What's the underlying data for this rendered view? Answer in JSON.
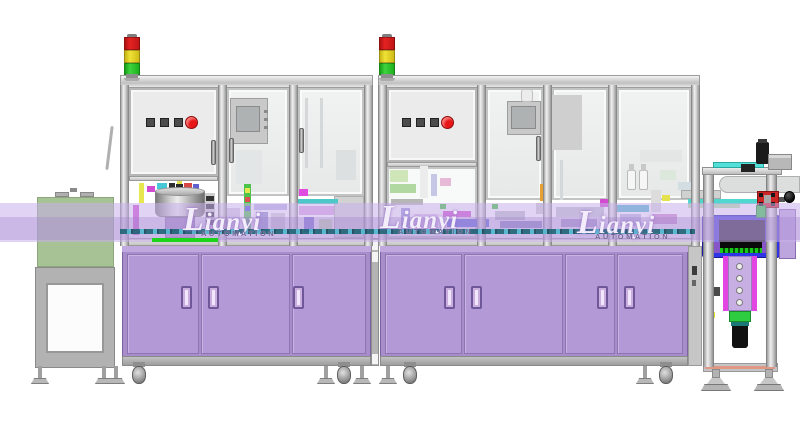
{
  "watermark": {
    "brand": "Lianyi",
    "sub": "AUTOMATION",
    "brand_color": "rgba(252,250,255,0.9)",
    "sub_color": "rgba(100,84,140,0.9)",
    "positions": [
      {
        "x": 183,
        "y": 201
      },
      {
        "x": 380,
        "y": 199
      },
      {
        "x": 577,
        "y": 204
      }
    ]
  },
  "palette": {
    "cabinet": "#a78ecb",
    "cabinet_door": "#b39ad6",
    "band": "rgba(201,174,233,0.55)",
    "band_dark": "rgba(158,128,202,0.32)",
    "tunnel_green": "#a7c295",
    "accent_green": "#1bd41b",
    "blue_box": "#2f35e6",
    "magenta": "#e245e2",
    "slide_green": "#2ecc40",
    "clamp_red": "#cc2626",
    "signal_red": "#e62222",
    "signal_yellow": "#efe235",
    "signal_green": "#3ed43e",
    "button_red": "#e81616",
    "button_gray": "#4c4c4c",
    "wm_brand": "rgba(252,250,255,0.9)",
    "wm_sub": "rgba(100,84,140,0.9)"
  },
  "towers": [
    {
      "x": 124
    },
    {
      "x": 379
    }
  ],
  "machine1": {
    "posts": [
      120,
      218,
      289,
      364
    ],
    "buttons": {
      "squares": [
        146,
        160,
        174
      ],
      "sq_y": 118,
      "red_x": 185,
      "red_y": 116
    },
    "handles": [
      {
        "x": 211,
        "y": 140
      },
      {
        "x": 229,
        "y": 138
      },
      {
        "x": 299,
        "y": 128
      }
    ]
  },
  "machine2": {
    "posts": [
      378,
      477,
      543,
      608,
      691
    ],
    "buttons": {
      "squares": [
        402,
        416,
        430
      ],
      "sq_y": 118,
      "red_x": 441,
      "red_y": 116
    },
    "handles": [
      {
        "x": 536,
        "y": 136
      },
      {
        "x": 546,
        "y": 132
      }
    ]
  },
  "cabinet1": {
    "x": 122,
    "w": 249,
    "doors": [
      [
        127,
        72
      ],
      [
        201,
        89
      ],
      [
        292,
        74
      ]
    ],
    "handles": [
      181,
      208,
      293
    ]
  },
  "cabinet2": {
    "x": 380,
    "w": 308,
    "doors": [
      [
        385,
        77
      ],
      [
        464,
        99
      ],
      [
        565,
        50
      ],
      [
        617,
        66
      ]
    ],
    "handles": [
      444,
      471,
      597,
      624
    ]
  },
  "junction": {
    "white_blocks": [
      240,
      252,
      354
    ]
  },
  "station3": {
    "holes": [
      263,
      275,
      287,
      299
    ]
  },
  "supports": {
    "feet": [
      40,
      104,
      116,
      326,
      362,
      388,
      645
    ],
    "casters": [
      139,
      344,
      410,
      666
    ],
    "big_feet": [
      716,
      769
    ]
  },
  "blocks": [
    {
      "x": 133,
      "y": 205,
      "w": 6,
      "h": 30,
      "c": "#cf49cf"
    },
    {
      "x": 139,
      "y": 183,
      "w": 5,
      "h": 20,
      "c": "#e6e64e"
    },
    {
      "x": 147,
      "y": 186,
      "w": 8,
      "h": 6,
      "c": "#d24cd2"
    },
    {
      "x": 157,
      "y": 183,
      "w": 10,
      "h": 6,
      "c": "#46c8d8"
    },
    {
      "x": 169,
      "y": 183,
      "w": 6,
      "h": 6,
      "c": "#2d2d2d"
    },
    {
      "x": 177,
      "y": 181,
      "w": 5,
      "h": 9,
      "c": "#dede46"
    },
    {
      "x": 184,
      "y": 183,
      "w": 8,
      "h": 6,
      "c": "#d84646"
    },
    {
      "x": 193,
      "y": 184,
      "w": 6,
      "h": 5,
      "c": "#6060d0"
    },
    {
      "x": 176,
      "y": 184,
      "w": 7,
      "h": 6,
      "c": "#2a2a2a"
    },
    {
      "x": 205,
      "y": 193,
      "w": 10,
      "h": 36,
      "c": "#cfcfcf"
    },
    {
      "x": 206,
      "y": 196,
      "w": 8,
      "h": 5,
      "c": "#333333"
    },
    {
      "x": 206,
      "y": 204,
      "w": 8,
      "h": 5,
      "c": "#333333"
    },
    {
      "x": 206,
      "y": 212,
      "w": 8,
      "h": 5,
      "c": "#333333"
    },
    {
      "x": 206,
      "y": 220,
      "w": 8,
      "h": 5,
      "c": "#333333"
    },
    {
      "x": 222,
      "y": 208,
      "w": 18,
      "h": 22,
      "c": "#d7cfe6"
    },
    {
      "x": 244,
      "y": 182,
      "w": 7,
      "h": 50,
      "c": "#4cc44c"
    },
    {
      "x": 245,
      "y": 188,
      "w": 5,
      "h": 5,
      "c": "#e6e64e"
    },
    {
      "x": 245,
      "y": 197,
      "w": 5,
      "h": 5,
      "c": "#e05050"
    },
    {
      "x": 245,
      "y": 206,
      "w": 5,
      "h": 5,
      "c": "#5050e0"
    },
    {
      "x": 254,
      "y": 204,
      "w": 33,
      "h": 6,
      "c": "#b9b9e6"
    },
    {
      "x": 256,
      "y": 212,
      "w": 12,
      "h": 20,
      "c": "#9090cc"
    },
    {
      "x": 271,
      "y": 213,
      "w": 14,
      "h": 18,
      "c": "#d2d2d2"
    },
    {
      "x": 299,
      "y": 189,
      "w": 9,
      "h": 7,
      "c": "#e04ce0"
    },
    {
      "x": 296,
      "y": 199,
      "w": 42,
      "h": 5,
      "c": "#4cc8c8"
    },
    {
      "x": 299,
      "y": 206,
      "w": 35,
      "h": 9,
      "c": "#d9a6e6"
    },
    {
      "x": 304,
      "y": 217,
      "w": 10,
      "h": 15,
      "c": "#6a6ad6"
    },
    {
      "x": 319,
      "y": 219,
      "w": 13,
      "h": 13,
      "c": "#c9e6a6"
    },
    {
      "x": 236,
      "y": 150,
      "w": 26,
      "h": 34,
      "c": "#e3e6e6"
    },
    {
      "x": 305,
      "y": 98,
      "w": 3,
      "h": 70,
      "c": "#d4d8d8"
    },
    {
      "x": 320,
      "y": 98,
      "w": 3,
      "h": 70,
      "c": "#d4d8d8"
    },
    {
      "x": 336,
      "y": 150,
      "w": 20,
      "h": 30,
      "c": "#dde0e0"
    },
    {
      "x": 390,
      "y": 170,
      "w": 18,
      "h": 12,
      "c": "#cfe6b9"
    },
    {
      "x": 390,
      "y": 184,
      "w": 26,
      "h": 9,
      "c": "#b0d8a0"
    },
    {
      "x": 420,
      "y": 166,
      "w": 8,
      "h": 32,
      "c": "#ececec"
    },
    {
      "x": 431,
      "y": 174,
      "w": 6,
      "h": 22,
      "c": "#c6c6e6"
    },
    {
      "x": 391,
      "y": 199,
      "w": 32,
      "h": 6,
      "c": "#b6b6b6"
    },
    {
      "x": 440,
      "y": 178,
      "w": 11,
      "h": 8,
      "c": "#e6b9d6"
    },
    {
      "x": 401,
      "y": 208,
      "w": 9,
      "h": 26,
      "c": "#9a9ad9"
    },
    {
      "x": 414,
      "y": 214,
      "w": 24,
      "h": 19,
      "c": "#e2cdf0"
    },
    {
      "x": 440,
      "y": 204,
      "w": 6,
      "h": 5,
      "c": "#33c633"
    },
    {
      "x": 443,
      "y": 211,
      "w": 28,
      "h": 6,
      "c": "#cc4ccc"
    },
    {
      "x": 447,
      "y": 219,
      "w": 42,
      "h": 8,
      "c": "#4a5ae2"
    },
    {
      "x": 452,
      "y": 229,
      "w": 32,
      "h": 5,
      "c": "#a092c6"
    },
    {
      "x": 548,
      "y": 95,
      "w": 34,
      "h": 55,
      "c": "#cfcfcf"
    },
    {
      "x": 560,
      "y": 160,
      "w": 3,
      "h": 40,
      "c": "#d4d8d8"
    },
    {
      "x": 640,
      "y": 150,
      "w": 42,
      "h": 12,
      "c": "#e4e6e6"
    },
    {
      "x": 492,
      "y": 204,
      "w": 6,
      "h": 5,
      "c": "#33c833"
    },
    {
      "x": 495,
      "y": 211,
      "w": 30,
      "h": 9,
      "c": "#bcc0cc"
    },
    {
      "x": 500,
      "y": 221,
      "w": 42,
      "h": 7,
      "c": "#8484c4"
    },
    {
      "x": 540,
      "y": 184,
      "w": 5,
      "h": 17,
      "c": "#e8a033"
    },
    {
      "x": 547,
      "y": 184,
      "w": 5,
      "h": 17,
      "c": "#e8a033"
    },
    {
      "x": 536,
      "y": 203,
      "w": 16,
      "h": 11,
      "c": "#cccccc"
    },
    {
      "x": 556,
      "y": 207,
      "w": 48,
      "h": 10,
      "c": "#c2c6ce"
    },
    {
      "x": 561,
      "y": 219,
      "w": 36,
      "h": 8,
      "c": "#a89ccc"
    },
    {
      "x": 600,
      "y": 199,
      "w": 8,
      "h": 8,
      "c": "#d24cd2"
    },
    {
      "x": 611,
      "y": 205,
      "w": 38,
      "h": 7,
      "c": "#4cbac9"
    },
    {
      "x": 620,
      "y": 214,
      "w": 21,
      "h": 12,
      "c": "#babade"
    },
    {
      "x": 651,
      "y": 190,
      "w": 10,
      "h": 22,
      "c": "#dcdcdc"
    },
    {
      "x": 652,
      "y": 214,
      "w": 25,
      "h": 10,
      "c": "#cc8ccc"
    },
    {
      "x": 662,
      "y": 195,
      "w": 8,
      "h": 6,
      "c": "#e6e24e"
    },
    {
      "x": 660,
      "y": 170,
      "w": 16,
      "h": 10,
      "c": "#dce8dc"
    },
    {
      "x": 678,
      "y": 182,
      "w": 14,
      "h": 8,
      "c": "#d2dee2"
    },
    {
      "x": 704,
      "y": 256,
      "w": 9,
      "h": 7,
      "c": "#3a3a3a"
    },
    {
      "x": 767,
      "y": 256,
      "w": 9,
      "h": 7,
      "c": "#3a3a3a"
    },
    {
      "x": 712,
      "y": 287,
      "w": 8,
      "h": 9,
      "c": "#4a4a4a"
    },
    {
      "x": 708,
      "y": 312,
      "w": 7,
      "h": 6,
      "c": "#e6e233"
    },
    {
      "x": 767,
      "y": 312,
      "w": 6,
      "h": 6,
      "c": "#e6e233"
    },
    {
      "x": 692,
      "y": 266,
      "w": 5,
      "h": 9,
      "c": "#3c3c3c"
    },
    {
      "x": 692,
      "y": 280,
      "w": 4,
      "h": 6,
      "c": "#666666"
    }
  ]
}
